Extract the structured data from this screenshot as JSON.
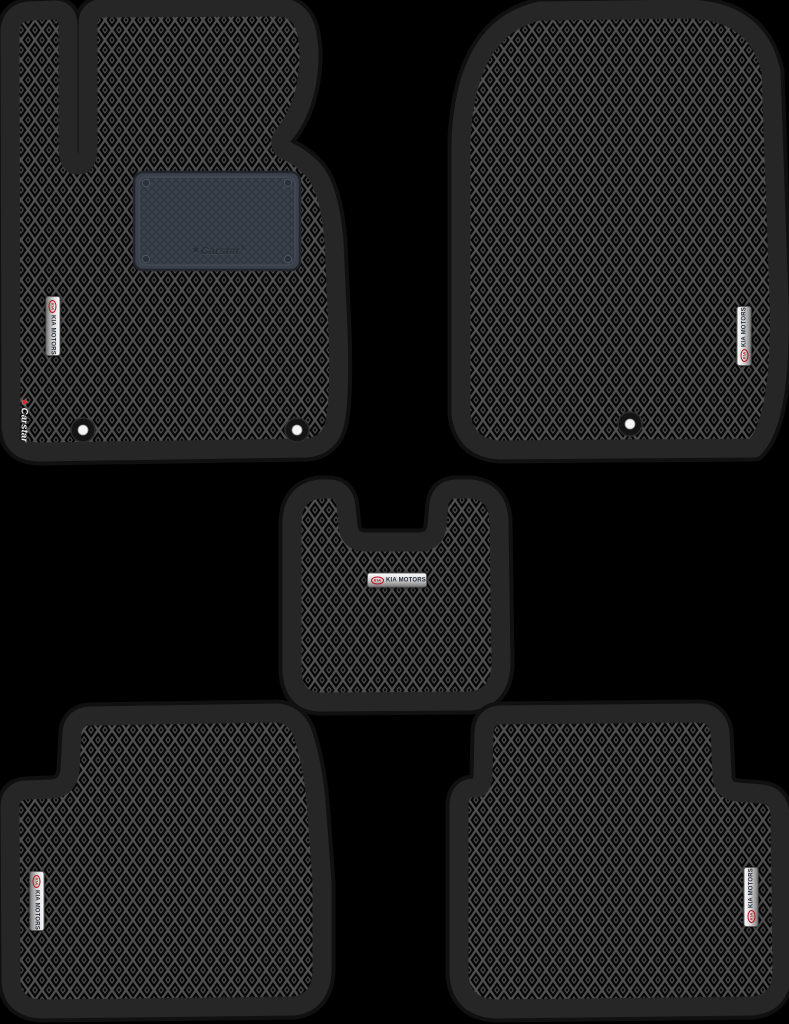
{
  "product": {
    "kind": "car-floor-mat-set",
    "pieces": 5,
    "mats": [
      {
        "id": "front-driver-mat",
        "badge_orientation": "vertical"
      },
      {
        "id": "front-passenger-mat",
        "badge_orientation": "vertical"
      },
      {
        "id": "center-tunnel-mat",
        "badge_orientation": "horizontal"
      },
      {
        "id": "rear-left-mat",
        "badge_orientation": "vertical"
      },
      {
        "id": "rear-right-mat",
        "badge_orientation": "vertical"
      }
    ]
  },
  "badge": {
    "logo": "KIA",
    "label": "KIA MOTORS"
  },
  "heel_pad": {
    "star": "★",
    "brand": "Carstar",
    "reg": "®"
  },
  "edge_logo": {
    "star": "★",
    "brand": "Carstar"
  },
  "colors": {
    "background": "#000000",
    "mat_border_band": "#262626",
    "mat_outer_rim": "#101010",
    "pattern_line": "#4f4f4f",
    "pattern_cell": "#050505",
    "heel_pad": "#3a414b",
    "badge_chrome": "#d9d9d9",
    "badge_red": "#b5121a",
    "badge_text": "#222a38",
    "edge_logo_text": "#f2f2f2",
    "edge_logo_star": "#d9232b",
    "fastener_dot": "#f5f5f5"
  }
}
